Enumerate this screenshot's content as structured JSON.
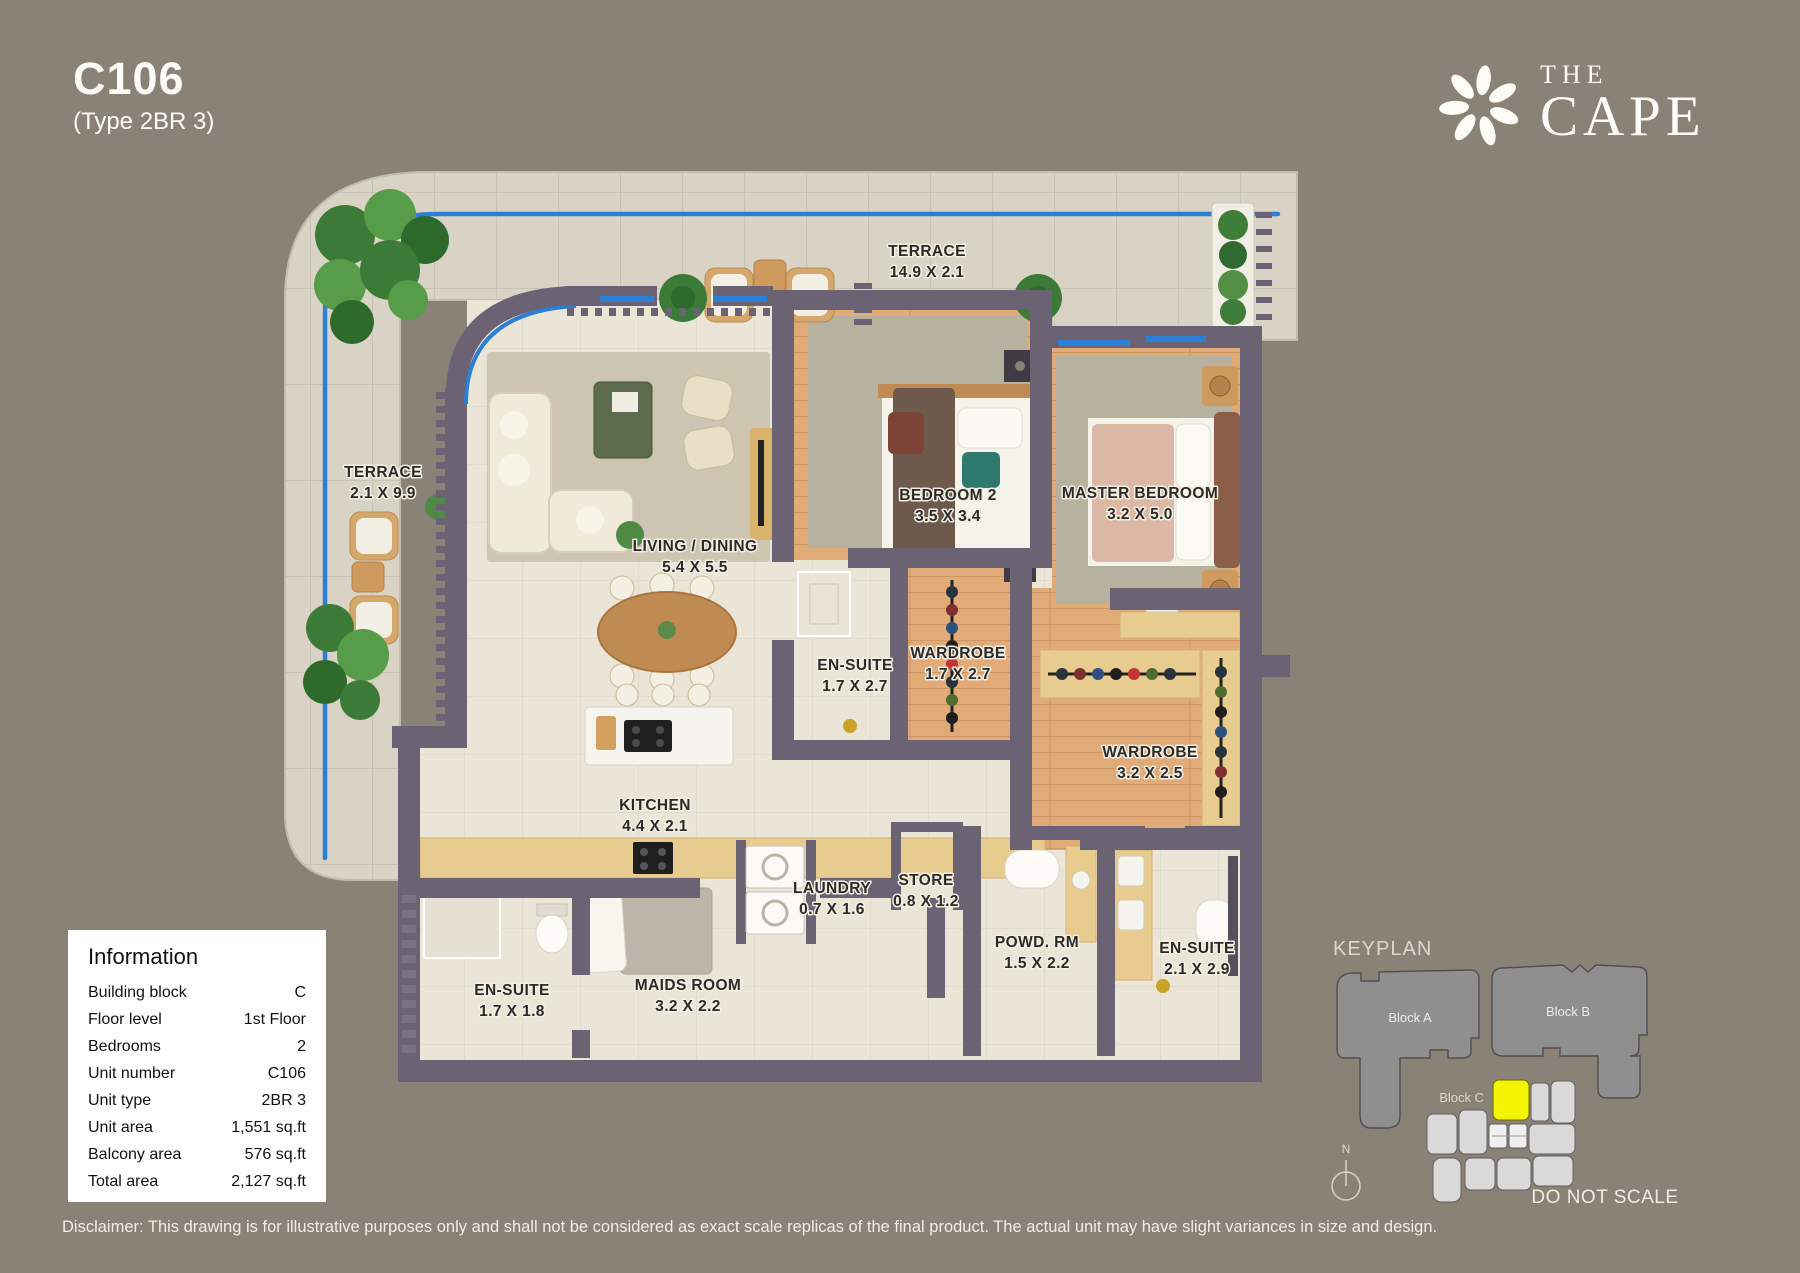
{
  "header": {
    "unit_code": "C106",
    "unit_type": "(Type 2BR 3)"
  },
  "brand": {
    "name_top": "THE",
    "name_bottom": "CAPE"
  },
  "floorplan": {
    "rooms": [
      {
        "id": "terrace-top",
        "label": "TERRACE",
        "dims": "14.9 X 2.1"
      },
      {
        "id": "terrace-left",
        "label": "TERRACE",
        "dims": "2.1 X 9.9"
      },
      {
        "id": "living-dining",
        "label": "LIVING / DINING",
        "dims": "5.4 X 5.5"
      },
      {
        "id": "bedroom-2",
        "label": "BEDROOM 2",
        "dims": "3.5 X 3.4"
      },
      {
        "id": "master-bedroom",
        "label": "MASTER BEDROOM",
        "dims": "3.2 X 5.0"
      },
      {
        "id": "ensuite-bedroom2",
        "label": "EN-SUITE",
        "dims": "1.7 X 2.7"
      },
      {
        "id": "wardrobe-bedroom2",
        "label": "WARDROBE",
        "dims": "1.7 X 2.7"
      },
      {
        "id": "wardrobe-master",
        "label": "WARDROBE",
        "dims": "3.2 X 2.5"
      },
      {
        "id": "kitchen",
        "label": "KITCHEN",
        "dims": "4.4 X 2.1"
      },
      {
        "id": "laundry",
        "label": "LAUNDRY",
        "dims": "0.7 X 1.6"
      },
      {
        "id": "store",
        "label": "STORE",
        "dims": "0.8 X 1.2"
      },
      {
        "id": "powder-room",
        "label": "POWD. RM",
        "dims": "1.5 X 2.2"
      },
      {
        "id": "ensuite-master",
        "label": "EN-SUITE",
        "dims": "2.1 X 2.9"
      },
      {
        "id": "ensuite-maids",
        "label": "EN-SUITE",
        "dims": "1.7 X 1.8"
      },
      {
        "id": "maids-room",
        "label": "MAIDS ROOM",
        "dims": "3.2 X 2.2"
      }
    ]
  },
  "information": {
    "title": "Information",
    "rows": [
      {
        "label": "Building block",
        "value": "C"
      },
      {
        "label": "Floor level",
        "value": "1st Floor"
      },
      {
        "label": "Bedrooms",
        "value": "2"
      },
      {
        "label": "Unit number",
        "value": "C106"
      },
      {
        "label": "Unit type",
        "value": "2BR 3"
      },
      {
        "label": "Unit area",
        "value": "1,551 sq.ft"
      },
      {
        "label": "Balcony area",
        "value": "576 sq.ft"
      },
      {
        "label": "Total area",
        "value": "2,127 sq.ft"
      }
    ]
  },
  "keyplan": {
    "title": "KEYPLAN",
    "block_a": "Block A",
    "block_b": "Block B",
    "block_c": "Block C",
    "compass_label": "N",
    "do_not_scale": "DO NOT SCALE"
  },
  "disclaimer": "Disclaimer: This drawing is for illustrative purposes only and shall not be considered as exact scale replicas of the final product. The actual unit may have slight variances in size and design.",
  "colors": {
    "background": "#8a8177",
    "wall": "#6b6273",
    "accent_blue": "#2b7fd4",
    "highlight_yellow": "#f4f400",
    "terrace_tile": "#d9d3c5",
    "wood_floor": "#e0ab79",
    "cream_floor": "#eae5d7"
  }
}
